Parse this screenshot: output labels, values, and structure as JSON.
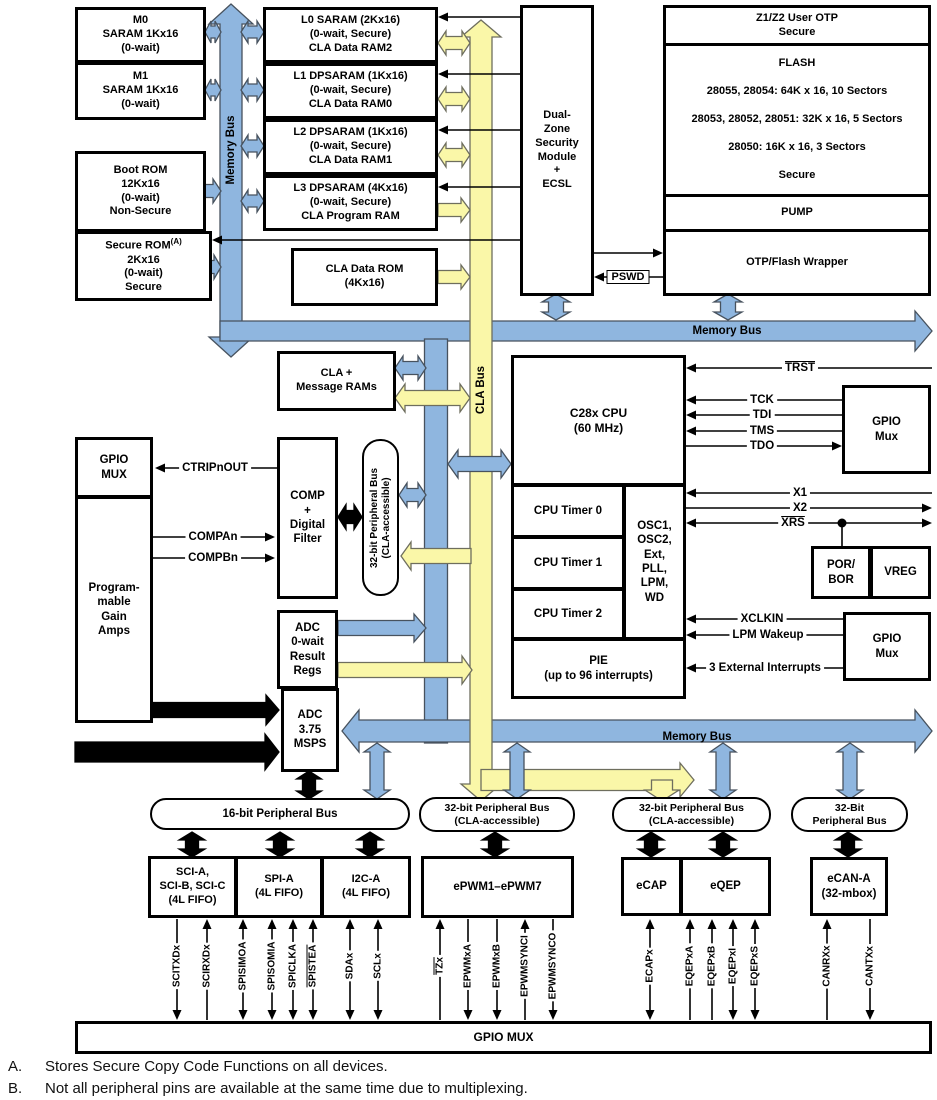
{
  "colors": {
    "bus_blue": "#8FB6DF",
    "bus_yellow": "#FAF7A8",
    "outline": "#000000"
  },
  "blocks": {
    "m0": [
      "M0",
      "SARAM 1Kx16",
      "(0-wait)"
    ],
    "m1": [
      "M1",
      "SARAM 1Kx16",
      "(0-wait)"
    ],
    "boot_rom": [
      "Boot ROM",
      "12Kx16",
      "(0-wait)",
      "Non-Secure"
    ],
    "secure_rom": {
      "name": "Secure ROM",
      "sup": "(A)",
      "lines": [
        "2Kx16",
        "(0-wait)",
        "Secure"
      ]
    },
    "l0": [
      "L0 SARAM (2Kx16)",
      "(0-wait, Secure)",
      "CLA Data RAM2"
    ],
    "l1": [
      "L1 DPSARAM (1Kx16)",
      "(0-wait, Secure)",
      "CLA Data RAM0"
    ],
    "l2": [
      "L2 DPSARAM (1Kx16)",
      "(0-wait, Secure)",
      "CLA Data RAM1"
    ],
    "l3": [
      "L3 DPSARAM (4Kx16)",
      "(0-wait, Secure)",
      "CLA Program RAM"
    ],
    "cla_data_rom": [
      "CLA Data ROM",
      "(4Kx16)"
    ],
    "security_module": [
      "Dual-",
      "Zone",
      "Security",
      "Module",
      "+",
      "ECSL"
    ],
    "user_otp": [
      "Z1/Z2 User OTP",
      "Secure"
    ],
    "flash": [
      "FLASH",
      "28055, 28054: 64K x 16, 10 Sectors",
      "28053, 28052, 28051: 32K x 16, 5 Sectors",
      "28050: 16K x 16, 3 Sectors",
      "Secure"
    ],
    "pump": "PUMP",
    "flash_wrapper": "OTP/Flash Wrapper",
    "cla_message_rams": [
      "CLA +",
      "Message RAMs"
    ],
    "cpu": [
      "C28x CPU",
      "(60 MHz)"
    ],
    "timer0": "CPU Timer 0",
    "timer1": "CPU Timer 1",
    "timer2": "CPU Timer 2",
    "osc": [
      "OSC1,",
      "OSC2,",
      "Ext,",
      "PLL,",
      "LPM,",
      "WD"
    ],
    "pie": [
      "PIE",
      "(up to 96 interrupts)"
    ],
    "gpio_mux_jtag": [
      "GPIO",
      "Mux"
    ],
    "por_bor": [
      "POR/",
      "BOR"
    ],
    "vreg": "VREG",
    "gpio_mux_wakeup": [
      "GPIO",
      "Mux"
    ],
    "gpio_mux_left": [
      "GPIO",
      "MUX"
    ],
    "pga": [
      "Program-",
      "mable",
      "Gain",
      "Amps"
    ],
    "comp": [
      "COMP",
      "+",
      "Digital",
      "Filter"
    ],
    "adc_result": [
      "ADC",
      "0-wait",
      "Result",
      "Regs"
    ],
    "adc": [
      "ADC",
      "3.75",
      "MSPS"
    ],
    "sci": [
      "SCI-A,",
      "SCI-B, SCI-C",
      "(4L FIFO)"
    ],
    "spi": [
      "SPI-A",
      "(4L FIFO)"
    ],
    "i2c": [
      "I2C-A",
      "(4L FIFO)"
    ],
    "epwm": "ePWM1–ePWM7",
    "ecap": "eCAP",
    "eqep": "eQEP",
    "ecan": [
      "eCAN-A",
      "(32-mbox)"
    ],
    "gpio_mux_bottom": "GPIO MUX"
  },
  "buses": {
    "memory_bus_vertical": "Memory Bus",
    "memory_bus_top": "Memory Bus",
    "memory_bus_bottom": "Memory Bus",
    "cla_bus": "CLA Bus",
    "peripheral_bus_32_vert": [
      "32-bit Peripheral Bus",
      "(CLA-accessible)"
    ],
    "peripheral_bus_16": "16-bit Peripheral Bus",
    "peripheral_bus_32_a": [
      "32-bit Peripheral Bus",
      "(CLA-accessible)"
    ],
    "peripheral_bus_32_b": [
      "32-bit Peripheral Bus",
      "(CLA-accessible)"
    ],
    "peripheral_bus_32_c": [
      "32-Bit",
      "Peripheral Bus"
    ]
  },
  "signals": {
    "trst": "TRST",
    "tck": "TCK",
    "tdi": "TDI",
    "tms": "TMS",
    "tdo": "TDO",
    "x1": "X1",
    "x2": "X2",
    "xrs": "XRS",
    "xclkin": "XCLKIN",
    "lpm_wakeup": "LPM Wakeup",
    "ext_interrupts": "3 External Interrupts",
    "pswd": "PSWD",
    "ctripnout": "CTRIPnOUT",
    "compan": "COMPAn",
    "compbn": "COMPBn"
  },
  "pins": [
    {
      "label": "SCITXDx",
      "dir": "out",
      "overline": false
    },
    {
      "label": "SCIRXDx",
      "dir": "in",
      "overline": false
    },
    {
      "label": "SPISIMOA",
      "dir": "bidir",
      "overline": false
    },
    {
      "label": "SPISOMIA",
      "dir": "bidir",
      "overline": false
    },
    {
      "label": "SPICLKA",
      "dir": "bidir",
      "overline": false
    },
    {
      "label": "SPISTEA",
      "dir": "bidir",
      "overline": true
    },
    {
      "label": "SDAx",
      "dir": "bidir",
      "overline": false
    },
    {
      "label": "SCLx",
      "dir": "bidir",
      "overline": false
    },
    {
      "label": "TZx",
      "dir": "in",
      "overline": true
    },
    {
      "label": "EPWMxA",
      "dir": "out",
      "overline": false
    },
    {
      "label": "EPWMxB",
      "dir": "out",
      "overline": false
    },
    {
      "label": "EPWMSYNCI",
      "dir": "in",
      "overline": false
    },
    {
      "label": "EPWMSYNCO",
      "dir": "out",
      "overline": false
    },
    {
      "label": "ECAPx",
      "dir": "bidir",
      "overline": false
    },
    {
      "label": "EQEPxA",
      "dir": "in",
      "overline": false
    },
    {
      "label": "EQEPxB",
      "dir": "in",
      "overline": false
    },
    {
      "label": "EQEPxI",
      "dir": "bidir",
      "overline": false
    },
    {
      "label": "EQEPxS",
      "dir": "bidir",
      "overline": false
    },
    {
      "label": "CANRXx",
      "dir": "in",
      "overline": false
    },
    {
      "label": "CANTXx",
      "dir": "out",
      "overline": false
    }
  ],
  "footnotes": [
    {
      "key": "A.",
      "text": "Stores Secure Copy Code Functions on all devices."
    },
    {
      "key": "B.",
      "text": "Not all peripheral pins are available at the same time due to multiplexing."
    }
  ]
}
